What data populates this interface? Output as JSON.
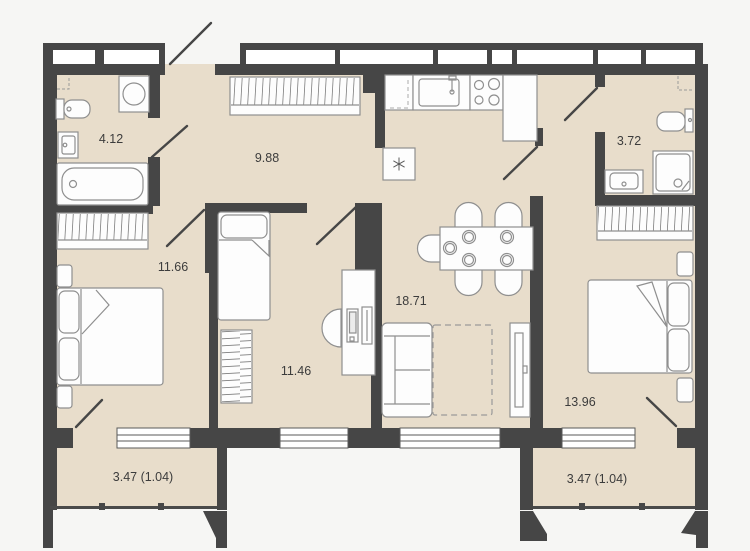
{
  "plan": {
    "type": "apartment-floor-plan",
    "rooms": [
      {
        "id": "bathroom-main",
        "area_label": "4.12"
      },
      {
        "id": "hallway",
        "area_label": "9.88"
      },
      {
        "id": "bathroom-second",
        "area_label": "3.72"
      },
      {
        "id": "bedroom-left",
        "area_label": "11.66"
      },
      {
        "id": "living-kitchen",
        "area_label": "18.71"
      },
      {
        "id": "bedroom-middle",
        "area_label": "11.46"
      },
      {
        "id": "bedroom-right",
        "area_label": "13.96"
      },
      {
        "id": "balcony-left",
        "area_label": "3.47 (1.04)"
      },
      {
        "id": "balcony-right",
        "area_label": "3.47 (1.04)"
      }
    ],
    "colors": {
      "background": "#f6f6f4",
      "wall": "#464646",
      "floor": "#e8ddcb",
      "furniture_fill": "#fdfdfd",
      "furniture_outline": "#8f8f8f",
      "label_text": "#3c3c3c"
    }
  }
}
